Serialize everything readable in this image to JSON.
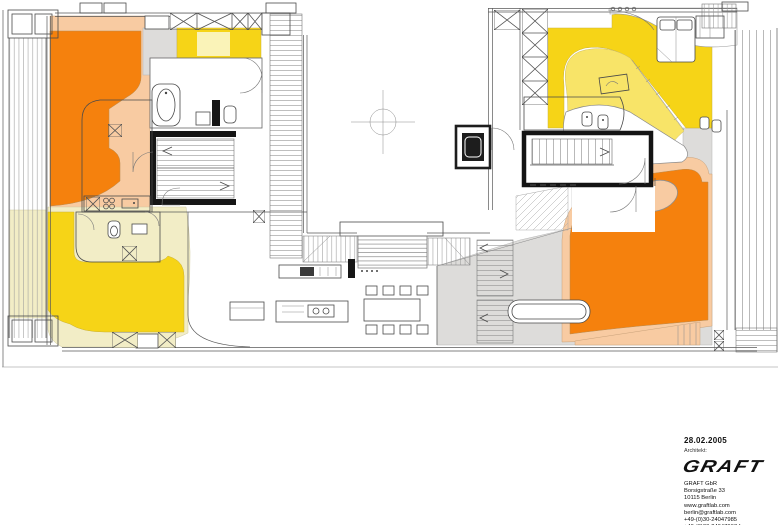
{
  "document": {
    "type": "architectural floor plan",
    "sheet_date": "28.02.2005"
  },
  "title_block": {
    "date": "28.02.2005",
    "role_label": "Architekt:",
    "logo_text": "GRAFT",
    "address": [
      "GRAFT GbR",
      "Borsigstraße 33",
      "10115 Berlin",
      "www.graftlab.com",
      "berlin@graftlab.com",
      "+49-(0)30-24047985",
      "+49-(0)30-24047967 fax"
    ]
  },
  "colors": {
    "orange": "#F5810D",
    "peach": "#F8CBA2",
    "yellow": "#F6D417",
    "yellow-light": "#F8E468",
    "yellow-pale": "#FAF3B8",
    "cream": "#F2EDC6",
    "gray": "#DDDCDA",
    "line": "#5a5a5a",
    "wall": "#161616"
  },
  "plan_zones": {
    "left_wing": [
      "orange zone",
      "peach zone",
      "yellow zone",
      "cream zone",
      "yellow room with pale inset"
    ],
    "right_wing": [
      "yellow zone with pale curved inset",
      "orange zone with peach border",
      "gray circulation zone"
    ],
    "center": [
      "courtyard with axis marker",
      "wide garden steps",
      "open living area"
    ]
  }
}
